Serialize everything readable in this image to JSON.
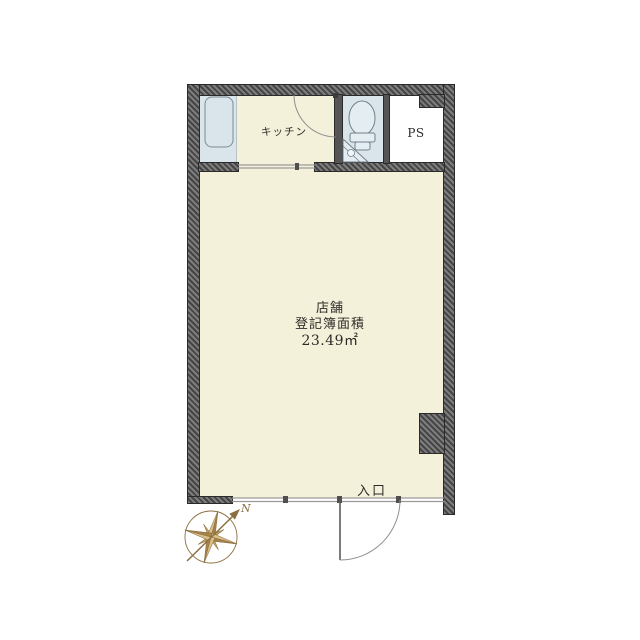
{
  "floorplan": {
    "main_room": {
      "name": "店舗",
      "area_label": "登記簿面積",
      "area_value": "23.49㎡"
    },
    "kitchen": {
      "label": "キッチン"
    },
    "pipe_space": {
      "label": "PS"
    },
    "entrance": {
      "label": "入口"
    },
    "compass": {
      "north": "N"
    }
  },
  "colors": {
    "room_cream": "#f4f1da",
    "room_blue": "#d9e5eb",
    "room_white": "#ffffff",
    "wall_dark": "#6f6f6f",
    "wall_hatch": "#454545",
    "compass_gold": "#c3a263",
    "line_gray": "#9a9a9a",
    "text": "#2e2c28"
  }
}
